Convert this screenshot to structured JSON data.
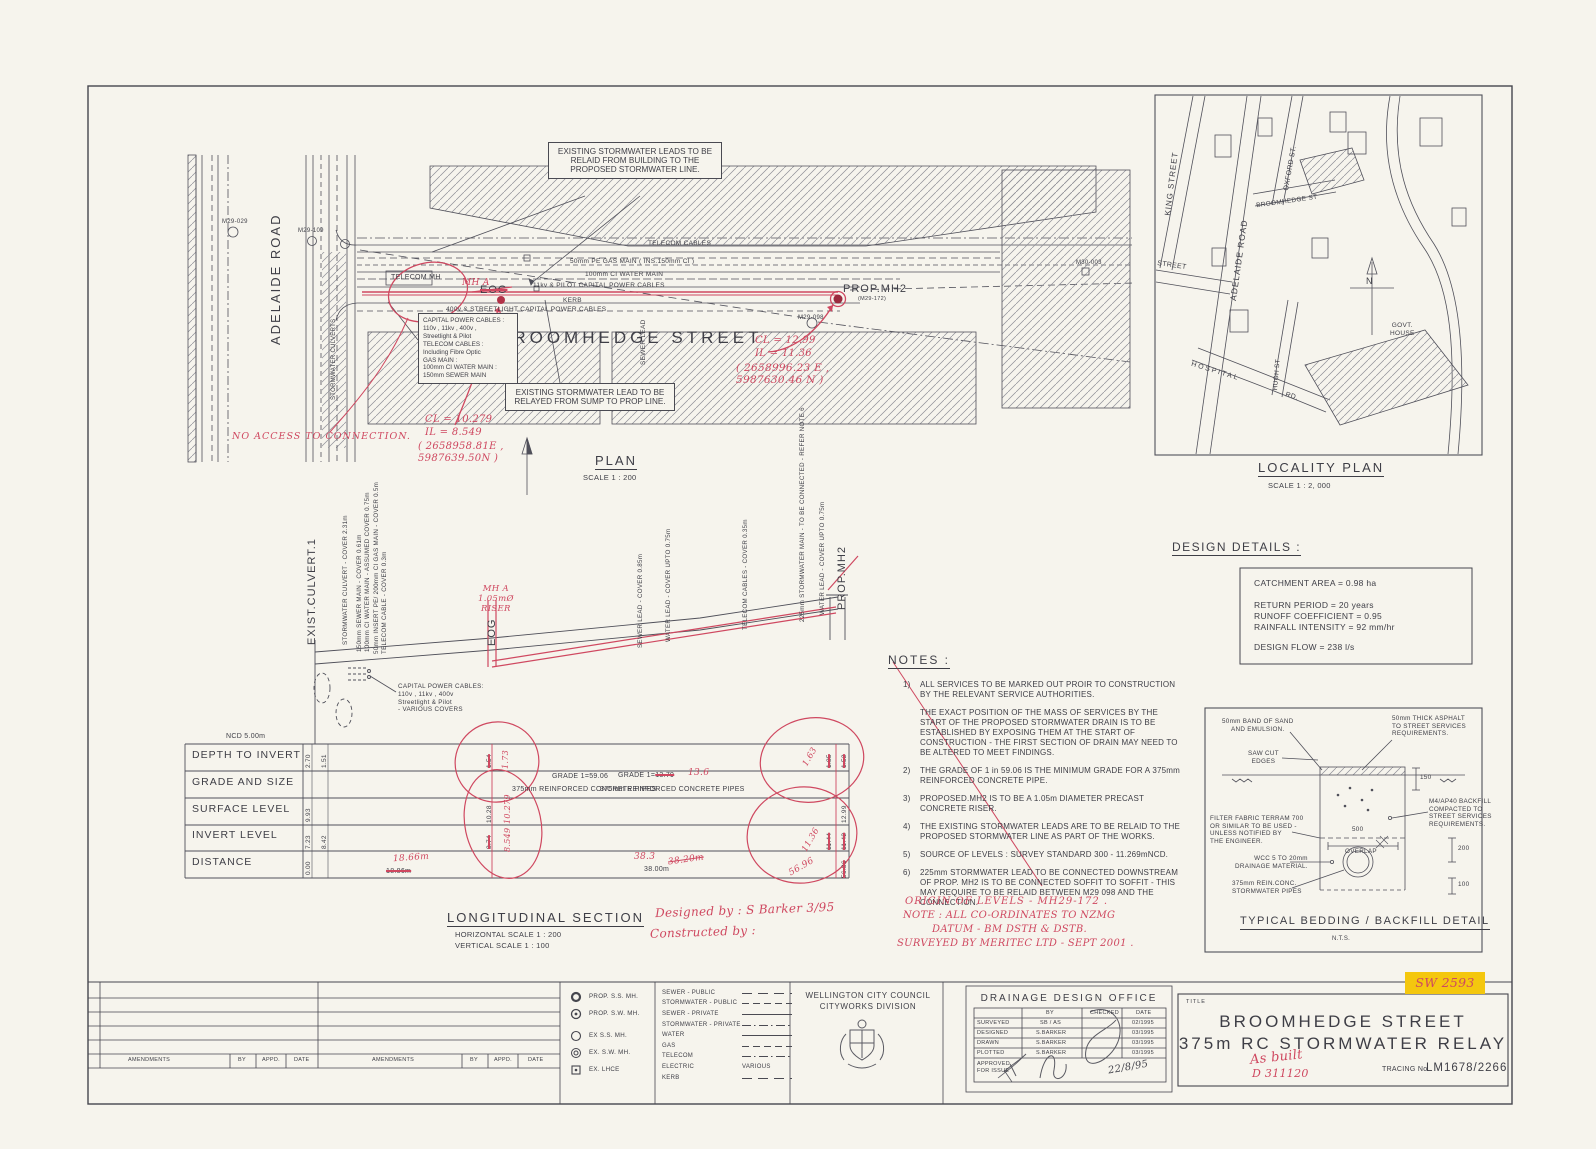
{
  "colors": {
    "paper": "#f6f4ed",
    "ink": "#3e3e46",
    "red_markup": "#cf4860",
    "highlight": "#f4c70e"
  },
  "plan": {
    "title": "PLAN",
    "scale": "SCALE 1 : 200",
    "adelaide": "ADELAIDE ROAD",
    "broomhedge": "BROOMHEDGE STREET",
    "culverts": "STORMWATER CULVERTS",
    "telecom_mh": "TELECOM MH",
    "sewer_lead": "SEWER LEAD",
    "labels": {
      "telecom_cables": "TELECOM CABLES",
      "gas_main": "50mm PE GAS MAIN ( INS.150mm CI )",
      "water_main": "100mm CI WATER MAIN",
      "power11": "11kv & PILOT CAPITAL POWER CABLES",
      "kerb": "KERB",
      "power400": "400v & STREETLIGHT CAPITAL POWER CABLES"
    },
    "mh": {
      "m29_029": "M29-029",
      "m29_109": "M29-109",
      "m29_098": "M29-098",
      "m30_003": "M30-003"
    },
    "eog": "EOG",
    "prop_mh2": "PROP.MH2",
    "prop_mh2_id": "(M29-172)",
    "note_top": "EXISTING STORMWATER LEADS TO BE RELAID FROM BUILDING TO THE PROPOSED STORMWATER LINE.",
    "services_box": "CAPITAL POWER CABLES :\n110v , 11kv , 400v ,\nStreetlight & Pilot\nTELECOM CABLES :\nIncluding Fibre Optic\nGAS MAIN :\n100mm CI WATER MAIN :\n150mm SEWER MAIN",
    "note_sump": "EXISTING STORMWATER LEAD TO BE RELAYED FROM SUMP TO PROP LINE.",
    "red": {
      "mh_a": "MH A",
      "no_access": "NO ACCESS TO CONNECTION.",
      "cl1": "CL = 10.279",
      "il1": "IL = 8.549",
      "coord1": "( 2658958.81E ,\n5987639.50N )",
      "cl2": "CL = 12.99",
      "il2": "IL = 11.36",
      "coord2": "( 2658996.23 E ,\n5987630.46 N )"
    }
  },
  "locality": {
    "title": "LOCALITY PLAN",
    "scale": "SCALE 1 : 2, 000",
    "north": "N",
    "streets": {
      "king": "KING STREET",
      "adelaide": "ADELAIDE ROAD",
      "oxford": "OXFORD ST.",
      "broomhedge": "BROOMHEDGE ST",
      "street": "STREET",
      "hospital": "HOSPITAL",
      "rd": "RD.",
      "hugh": "HUGH ST",
      "govt": "GOVT.\nHOUSE"
    }
  },
  "details": {
    "heading": "DESIGN DETAILS :",
    "l1": "CATCHMENT AREA = 0.98 ha",
    "l2": "RETURN PERIOD = 20 years",
    "l3": "RUNOFF COEFFICIENT = 0.95",
    "l4": "RAINFALL INTENSITY = 92 mm/hr",
    "l5": "DESIGN FLOW = 238 l/s"
  },
  "notes": {
    "heading": "NOTES :",
    "items": [
      {
        "num": "1)",
        "text": "ALL SERVICES TO BE MARKED OUT PROIR TO CONSTRUCTION BY THE RELEVANT SERVICE AUTHORITIES."
      },
      {
        "num": "",
        "text": "THE EXACT POSITION OF THE MASS OF SERVICES BY THE START OF THE PROPOSED STORMWATER DRAIN IS TO BE ESTABLISHED BY EXPOSING THEM AT THE START OF CONSTRUCTION - THE FIRST SECTION OF DRAIN MAY NEED TO BE ALTERED TO MEET FINDINGS."
      },
      {
        "num": "2)",
        "text": "THE GRADE OF 1 in 59.06 IS THE MINIMUM GRADE FOR A 375mm REINFORCED CONCRETE PIPE."
      },
      {
        "num": "3)",
        "text": "PROPOSED.MH2 IS TO BE A 1.05m DIAMETER PRECAST CONCRETE RISER."
      },
      {
        "num": "4)",
        "text": "THE EXISTING STORMWATER LEADS ARE TO BE RELAID TO THE PROPOSED STORMWATER LINE AS PART OF THE WORKS."
      },
      {
        "num": "5)",
        "text": "SOURCE OF LEVELS : SURVEY STANDARD 300 - 11.269mNCD."
      },
      {
        "num": "6)",
        "text": "225mm STORMWATER LEAD TO BE CONNECTED DOWNSTREAM OF PROP. MH2 IS TO BE CONNECTED SOFFIT TO SOFFIT - THIS MAY REQUIRE TO BE RELAID BETWEEN M29 098 AND THE CONNECTION."
      }
    ],
    "hand1": "ORIGIN OF LEVELS - MH29-172 .",
    "hand2": "NOTE : ALL CO-ORDINATES TO NZMG",
    "hand3": "DATUM - BM DSTH & DSTB.",
    "hand4": "SURVEYED BY MERITEC LTD - SEPT 2001 ."
  },
  "sec": {
    "title": "LONGITUDINAL SECTION",
    "hscale": "HORIZONTAL SCALE 1 : 200",
    "vscale": "VERTICAL SCALE   1 : 100",
    "datum": "NCD 5.00m",
    "labels": [
      "EXIST.CULVERT.1",
      "STORMWATER CULVERT - COVER 2.31m",
      "150mm SEWER MAIN - COVER 0.61m",
      "100mm CI WATER MAIN - ASSUMED COVER 0.75m",
      "50mm INSERT PE/ 200mm CI GAS MAIN - COVER 0.5m",
      "TELECOM CABLE - COVER 0.3m",
      "EOG",
      "SEWER LEAD - COVER  0.85m",
      "WATER LEAD - COVER UPTO 0.75m",
      "TELECOM CABLES - COVER 0.35m",
      "225mm STORMWATER MAIN - TO BE CONNECTED - REFER NOTE 6",
      "WATER LEAD - COVER UPTO 0.75m",
      "PROP.MH2"
    ],
    "mh_a": "MH A\n1.05mØ\nRISER",
    "cables": "CAPITAL POWER CABLES:\n110v , 11kv , 400v\nStreetlight & Pilot\n- VARIOUS COVERS",
    "hand_designed": "Designed by :  S Barker  3/95",
    "hand_constructed": "Constructed by :",
    "table": {
      "rows": [
        "DEPTH TO INVERT",
        "GRADE AND SIZE",
        "SURFACE LEVEL",
        "INVERT LEVEL",
        "DISTANCE"
      ],
      "depth_a": "2.70",
      "depth_b": "1.51",
      "depth_eog_old": "1.54",
      "depth_eog_new": "1.73",
      "depth_end_old1": "1.85",
      "depth_end_old2": "1.52",
      "depth_end_new": "1.63",
      "grade_left": "GRADE 1=59.06",
      "pipe_left": "375mm REINFORCED CONCRETE PIPES",
      "grade_right_a": "GRADE 1=",
      "grade_right_b": "13.79",
      "grade_right_new": "13.6",
      "pipe_right": "375mm REINFORCED CONCRETE PIPES",
      "surf_a": "9.93",
      "surf_eog_old": "10.28",
      "surf_eog_new": "10.279",
      "surf_end": "12.99",
      "inv_a": "7.23",
      "inv_b": "8.42",
      "inv_eog_old": "8.74",
      "inv_eog_new": "8.549",
      "inv_end_old1": "11.44",
      "inv_end_new": "11.36",
      "inv_end_old2": "11.42",
      "dist_a": "0.00",
      "dist_eog_old": "18.86m",
      "dist_eog_new": "18.66m",
      "dist_mid": "38.00m",
      "dist_mid_new": "38.3",
      "dist_mid_old": "38.20m",
      "dist_end_old": "56.86",
      "dist_end_new": "56.96"
    }
  },
  "bed": {
    "title": "TYPICAL BEDDING / BACKFILL DETAIL",
    "nts": "N.T.S.",
    "sand": "50mm BAND OF SAND\nAND EMULSION.",
    "asphalt": "50mm THICK ASPHALT\nTO STREET SERVICES\nREQUIREMENTS.",
    "sawcut": "SAW CUT\nEDGES",
    "dim150": "150",
    "backfill": "M4/AP40 BACKFILL\nCOMPACTED TO\nSTREET SERVICES\nREQUIREMENTS.",
    "filter": "FILTER FABRIC TERRAM 700\nOR SIMILAR TO BE USED -\nUNLESS NOTIFIED BY\nTHE ENGINEER.",
    "overlap_dim": "500",
    "overlap": "OVERLAP",
    "drainage": "WCC 5 TO 20mm\nDRAINAGE MATERIAL.",
    "pipes": "375mm REIN.CONC.\nSTORMWATER PIPES",
    "dim200": "200",
    "dim100": "100"
  },
  "legend": {
    "symbols": [
      "PROP. S.S. MH.",
      "PROP. S.W. MH.",
      "EX S.S. MH.",
      "EX. S.W. MH.",
      "EX. LHCE"
    ],
    "lines": [
      "SEWER - PUBLIC",
      "STORMWATER - PUBLIC",
      "SEWER - PRIVATE",
      "STORMWATER - PRIVATE",
      "WATER",
      "GAS",
      "TELECOM",
      "ELECTRIC",
      "KERB"
    ],
    "various": "VARIOUS"
  },
  "council": {
    "line1": "WELLINGTON CITY COUNCIL",
    "line2": "CITYWORKS DIVISION"
  },
  "office": {
    "heading": "DRAINAGE DESIGN OFFICE",
    "col_by": "BY",
    "col_checked": "CHECKED",
    "col_date": "DATE",
    "r1_label": "SURVEYED",
    "r1_by": "SB / AS",
    "r1_date": "02/1995",
    "r2_label": "DESIGNED",
    "r2_by": "S.BARKER",
    "r2_date": "03/1995",
    "r3_label": "DRAWN",
    "r3_by": "S.BARKER",
    "r3_date": "03/1995",
    "r4_label": "PLOTTED",
    "r4_by": "S.BARKER",
    "r4_date": "03/1995",
    "approved": "APPROVED\nFOR ISSUE",
    "approved_date": "22/8/95"
  },
  "tb": {
    "label": "TITLE",
    "line1": "BROOMHEDGE STREET",
    "line2": "375m RC STORMWATER RELAY",
    "tracing_label": "TRACING No.",
    "tracing_no": "LM1678/2266",
    "as_built": "As built",
    "d_no": "D 311120",
    "sw": "SW 2593"
  },
  "amend": [
    "AMENDMENTS",
    "BY",
    "APPD.",
    "DATE",
    "AMENDMENTS",
    "BY",
    "APPD.",
    "DATE"
  ],
  "north": "N"
}
